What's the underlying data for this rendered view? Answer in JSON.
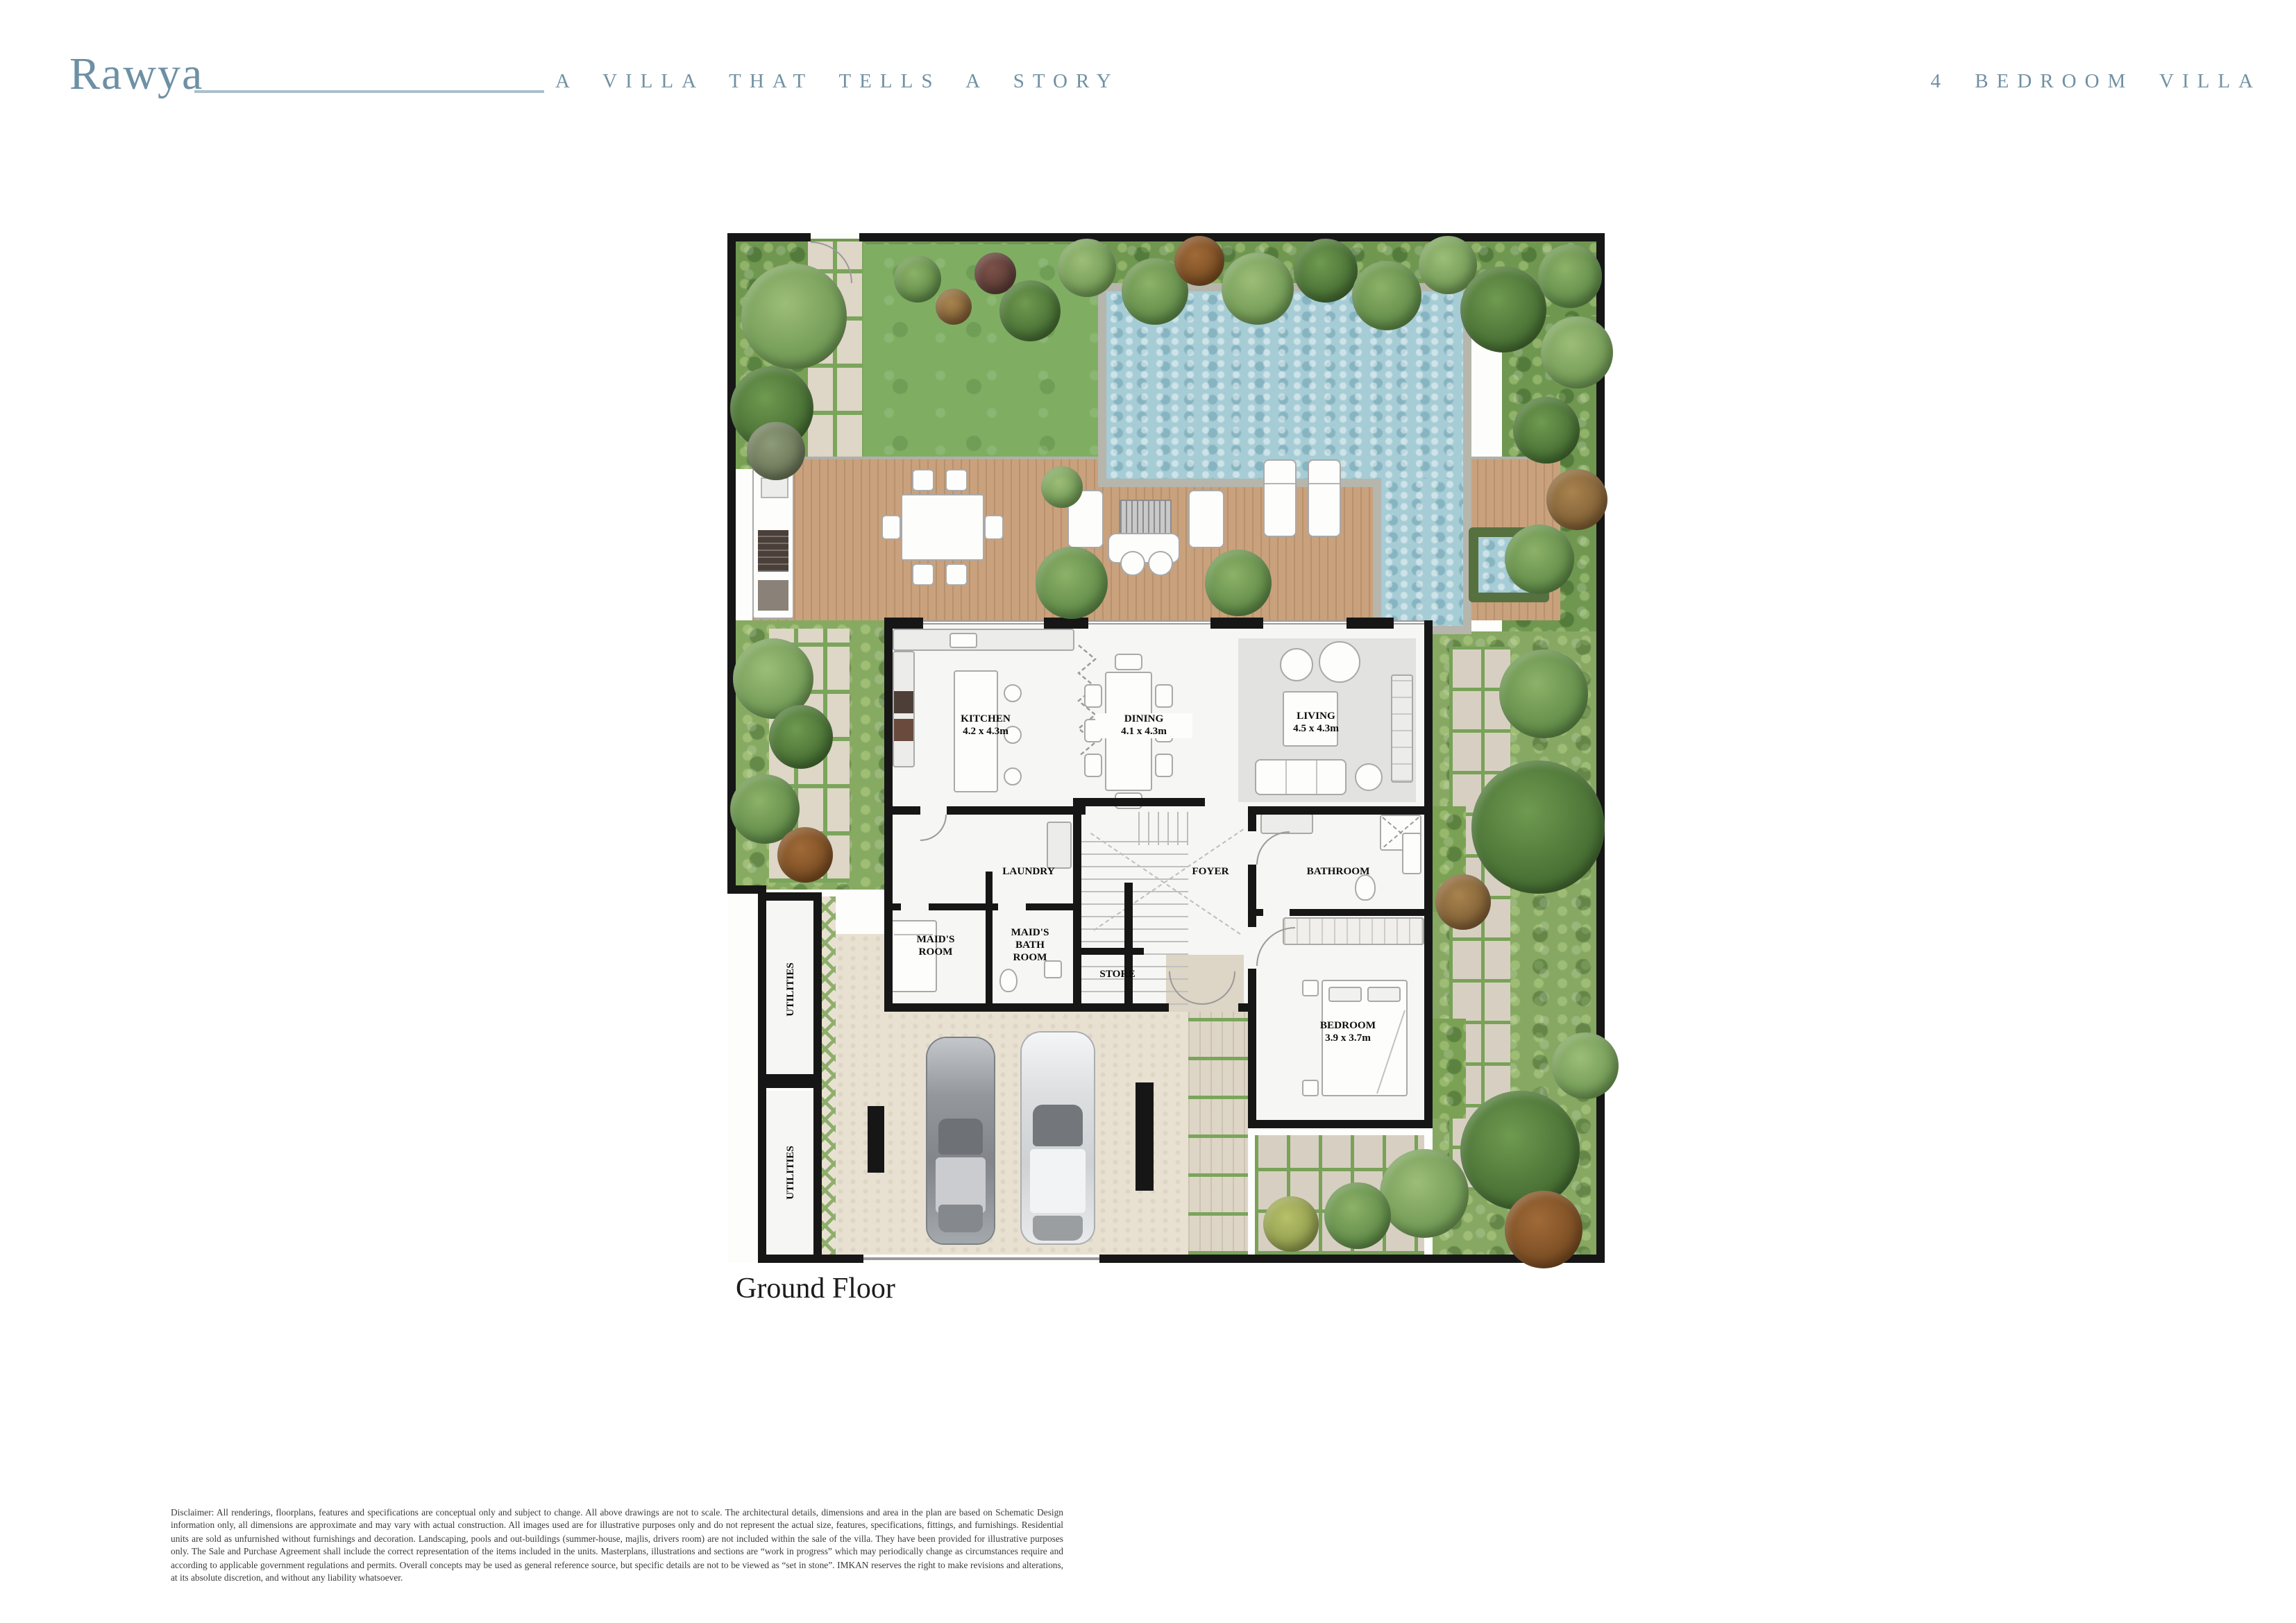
{
  "header": {
    "brand": "Rawya",
    "tagline": "A VILLA THAT TELLS A STORY",
    "unit_type": "4 BEDROOM VILLA"
  },
  "plan": {
    "title": "Ground Floor",
    "rooms": {
      "kitchen": {
        "name": "KITCHEN",
        "dims": "4.2 x 4.3m"
      },
      "dining": {
        "name": "DINING",
        "dims": "4.1 x 4.3m"
      },
      "living": {
        "name": "LIVING",
        "dims": "4.5 x 4.3m"
      },
      "laundry": {
        "name": "LAUNDRY"
      },
      "foyer": {
        "name": "FOYER"
      },
      "bathroom": {
        "name": "BATHROOM"
      },
      "maids_room": {
        "name": "MAID'S ROOM"
      },
      "maids_bath": {
        "name": "MAID'S BATH ROOM"
      },
      "store": {
        "name": "STORE"
      },
      "bedroom": {
        "name": "BEDROOM",
        "dims": "3.9 x 3.7m"
      },
      "utilities_1": {
        "name": "UTILITIES"
      },
      "utilities_2": {
        "name": "UTILITIES"
      }
    }
  },
  "footer": {
    "disclaimer": "Disclaimer: All renderings, floorplans, features and specifications are conceptual only and subject to change. All above drawings are not to scale. The architectural details, dimensions and area in the plan are based on Schematic Design information only, all dimensions are approximate and may vary with actual construction. All images used are for illustrative purposes only and do not represent the actual size, features, specifications, fittings, and furnishings. Residential units are sold as unfurnished without furnishings and decoration. Landscaping, pools and out-buildings (summer-house, majlis, drivers room) are not included within the sale of the villa. They have been provided for illustrative purposes only. The Sale and Purchase Agreement shall include the correct representation of the items included in the units. Masterplans, illustrations and sections are “work in progress” which may periodically change as circumstances require and according to applicable government regulations and permits. Overall concepts may be used as general reference source, but specific details are not to be viewed as “set in stone”. IMKAN reserves the right to make revisions and alterations, at its absolute discretion, and without any liability whatsoever."
  },
  "colors": {
    "brand_blue": "#6d90a4",
    "wall_black": "#161616",
    "pool_water": "#a6ccd6",
    "deck_wood": "#c9a17c",
    "lawn_green": "#7fae63",
    "paving_beige": "#e8e1d2"
  }
}
